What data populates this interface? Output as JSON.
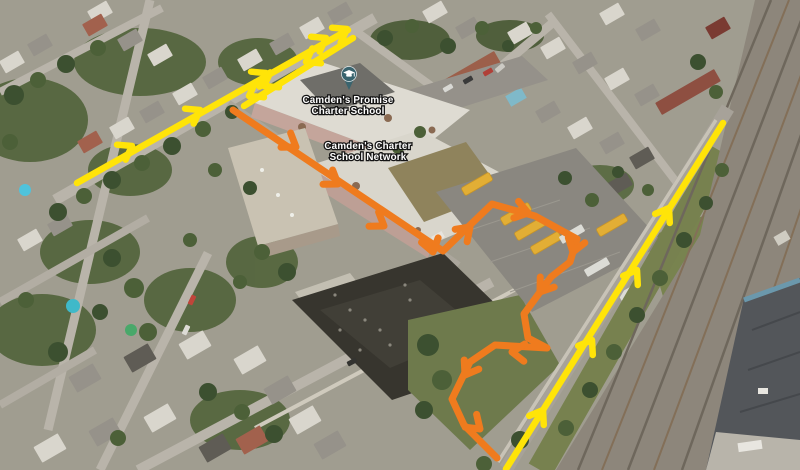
{
  "annotations": {
    "labels": [
      {
        "id": "school-label-promise",
        "lines": [
          "Camden's Promise",
          "Charter School"
        ],
        "x": 348,
        "y": 103
      },
      {
        "id": "school-label-network",
        "lines": [
          "Camden's Charter",
          "School Network"
        ],
        "x": 368,
        "y": 149
      }
    ],
    "marker": {
      "name": "school-map-pin",
      "x": 349,
      "y": 75,
      "color": "#3a646e",
      "glyph": "graduation-cap"
    },
    "route_colors": {
      "yellow": "#ffe408",
      "orange": "#ef7b1e"
    },
    "routes": [
      {
        "id": "yellow-street-northeast-lane",
        "color": "yellow",
        "width": 6.5,
        "points": [
          [
            77,
            183
          ],
          [
            348,
            30
          ]
        ],
        "arrows": [
          {
            "x": 132,
            "y": 146,
            "a": -30
          },
          {
            "x": 200,
            "y": 110,
            "a": -30
          },
          {
            "x": 266,
            "y": 73,
            "a": -30
          },
          {
            "x": 326,
            "y": 38,
            "a": -30
          },
          {
            "x": 347,
            "y": 29,
            "a": -30
          }
        ]
      },
      {
        "id": "yellow-street-southwest-lane",
        "color": "yellow",
        "width": 6.5,
        "points": [
          [
            353,
            38
          ],
          [
            244,
            106
          ]
        ],
        "arrows": [
          {
            "x": 306,
            "y": 62,
            "a": 150
          },
          {
            "x": 264,
            "y": 86,
            "a": 150
          },
          {
            "x": 249,
            "y": 96,
            "a": 150
          }
        ]
      },
      {
        "id": "yellow-railroad-road-lane",
        "color": "yellow",
        "width": 6.5,
        "points": [
          [
            506,
            469
          ],
          [
            723,
            123
          ]
        ],
        "arrows": [
          {
            "x": 543,
            "y": 410,
            "a": -58
          },
          {
            "x": 592,
            "y": 340,
            "a": -58
          },
          {
            "x": 637,
            "y": 270,
            "a": -58
          },
          {
            "x": 669,
            "y": 208,
            "a": -58
          }
        ]
      },
      {
        "id": "orange-bus-route",
        "color": "orange",
        "width": 7,
        "points": [
          [
            233,
            110
          ],
          [
            443,
            251
          ],
          [
            492,
            204
          ],
          [
            535,
            216
          ],
          [
            577,
            239
          ],
          [
            570,
            262
          ],
          [
            551,
            277
          ],
          [
            524,
            314
          ],
          [
            528,
            338
          ],
          [
            547,
            348
          ],
          [
            495,
            345
          ],
          [
            470,
            362
          ],
          [
            452,
            399
          ],
          [
            464,
            425
          ],
          [
            497,
            458
          ]
        ],
        "arrows": [
          {
            "x": 296,
            "y": 147,
            "a": 34
          },
          {
            "x": 338,
            "y": 184,
            "a": 34
          },
          {
            "x": 384,
            "y": 226,
            "a": 34
          },
          {
            "x": 433,
            "y": 252,
            "a": 75
          },
          {
            "x": 470,
            "y": 227,
            "a": -44
          },
          {
            "x": 528,
            "y": 213,
            "a": 16
          },
          {
            "x": 573,
            "y": 252,
            "a": 107
          },
          {
            "x": 540,
            "y": 292,
            "a": 126
          },
          {
            "x": 512,
            "y": 352,
            "a": 183
          },
          {
            "x": 465,
            "y": 375,
            "a": 122
          },
          {
            "x": 480,
            "y": 429,
            "a": 42
          }
        ]
      }
    ]
  }
}
